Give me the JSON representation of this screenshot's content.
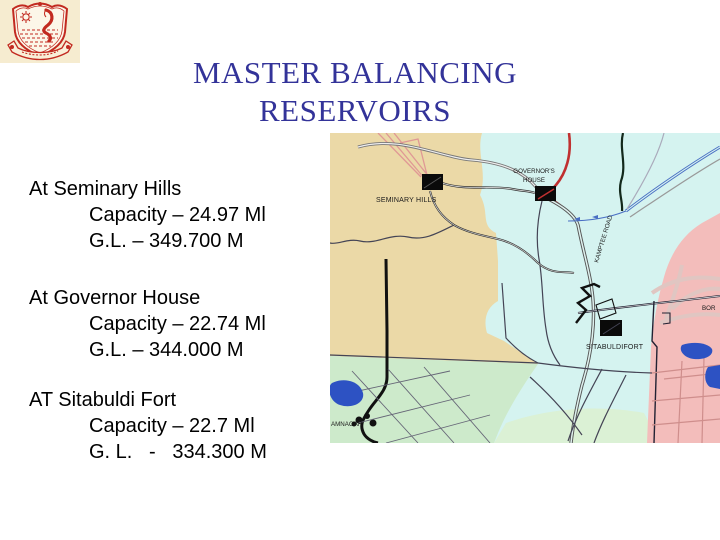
{
  "header": {
    "title_line1": "MASTER BALANCING",
    "title_line2": "RESERVOIRS",
    "title_color": "#333399"
  },
  "icons": {
    "logo": "municipal-corporation-crest"
  },
  "reservoirs": [
    {
      "name": "At Seminary Hills",
      "capacity": "Capacity – 24.97 Ml",
      "ground_level": "G.L. – 349.700 M"
    },
    {
      "name": "At Governor House",
      "capacity": "Capacity – 22.74 Ml",
      "ground_level": "G.L. – 344.000 M"
    },
    {
      "name": "AT Sitabuldi Fort",
      "capacity": "Capacity – 22.7 Ml",
      "ground_level": "G. L.   -   334.300 M"
    }
  ],
  "map": {
    "labels": {
      "seminary_hills": "SEMINARY HILLS",
      "governors_house_l1": "GOVERNOR'S",
      "governors_house_l2": "HOUSE",
      "sitabuldi_fort": "SITABULDIFORT",
      "kamptee_road": "KAMPTEE ROAD",
      "ramnagar": "AMNAGAR",
      "bor": "BOR"
    },
    "colors": {
      "zone_tan": "#ebd9a7",
      "zone_cyan": "#d5f3f0",
      "zone_pink": "#f3bdbb",
      "zone_green": "#cdeacb",
      "zone_pale_green": "#dbf1d5",
      "water_blue": "#2d52c3",
      "highway_red": "#c03030"
    }
  }
}
